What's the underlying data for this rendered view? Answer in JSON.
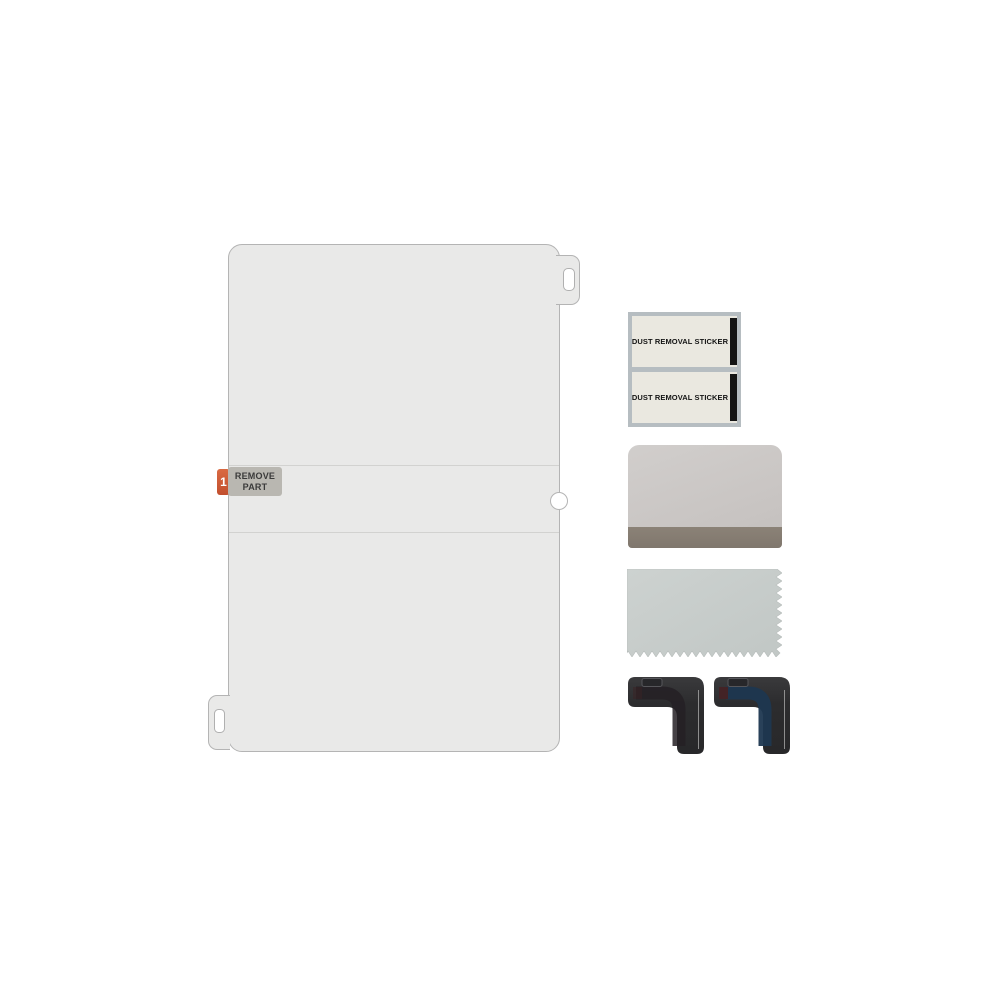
{
  "film": {
    "step_badge": "1",
    "remove_part_line1": "REMOVE",
    "remove_part_line2": "PART"
  },
  "dust_stickers": {
    "items": [
      {
        "label": "DUST REMOVAL STICKER"
      },
      {
        "label": "DUST REMOVAL STICKER"
      }
    ]
  },
  "colors": {
    "accent_orange": "#cf5a35",
    "film_gray": "#e9e9e8",
    "label_gray": "#b9b7b1",
    "sticker_frame": "#b6bdc1",
    "sticker_bg": "#eae8e0",
    "sticker_stripe": "#141414",
    "squeegee_body": "#cac6c4",
    "squeegee_edge": "#867d72",
    "cloth_gray": "#c6cbc9",
    "guide_black": "#2e2e30",
    "guide_blue": "#1d3750",
    "guide_maroon": "#432326"
  }
}
